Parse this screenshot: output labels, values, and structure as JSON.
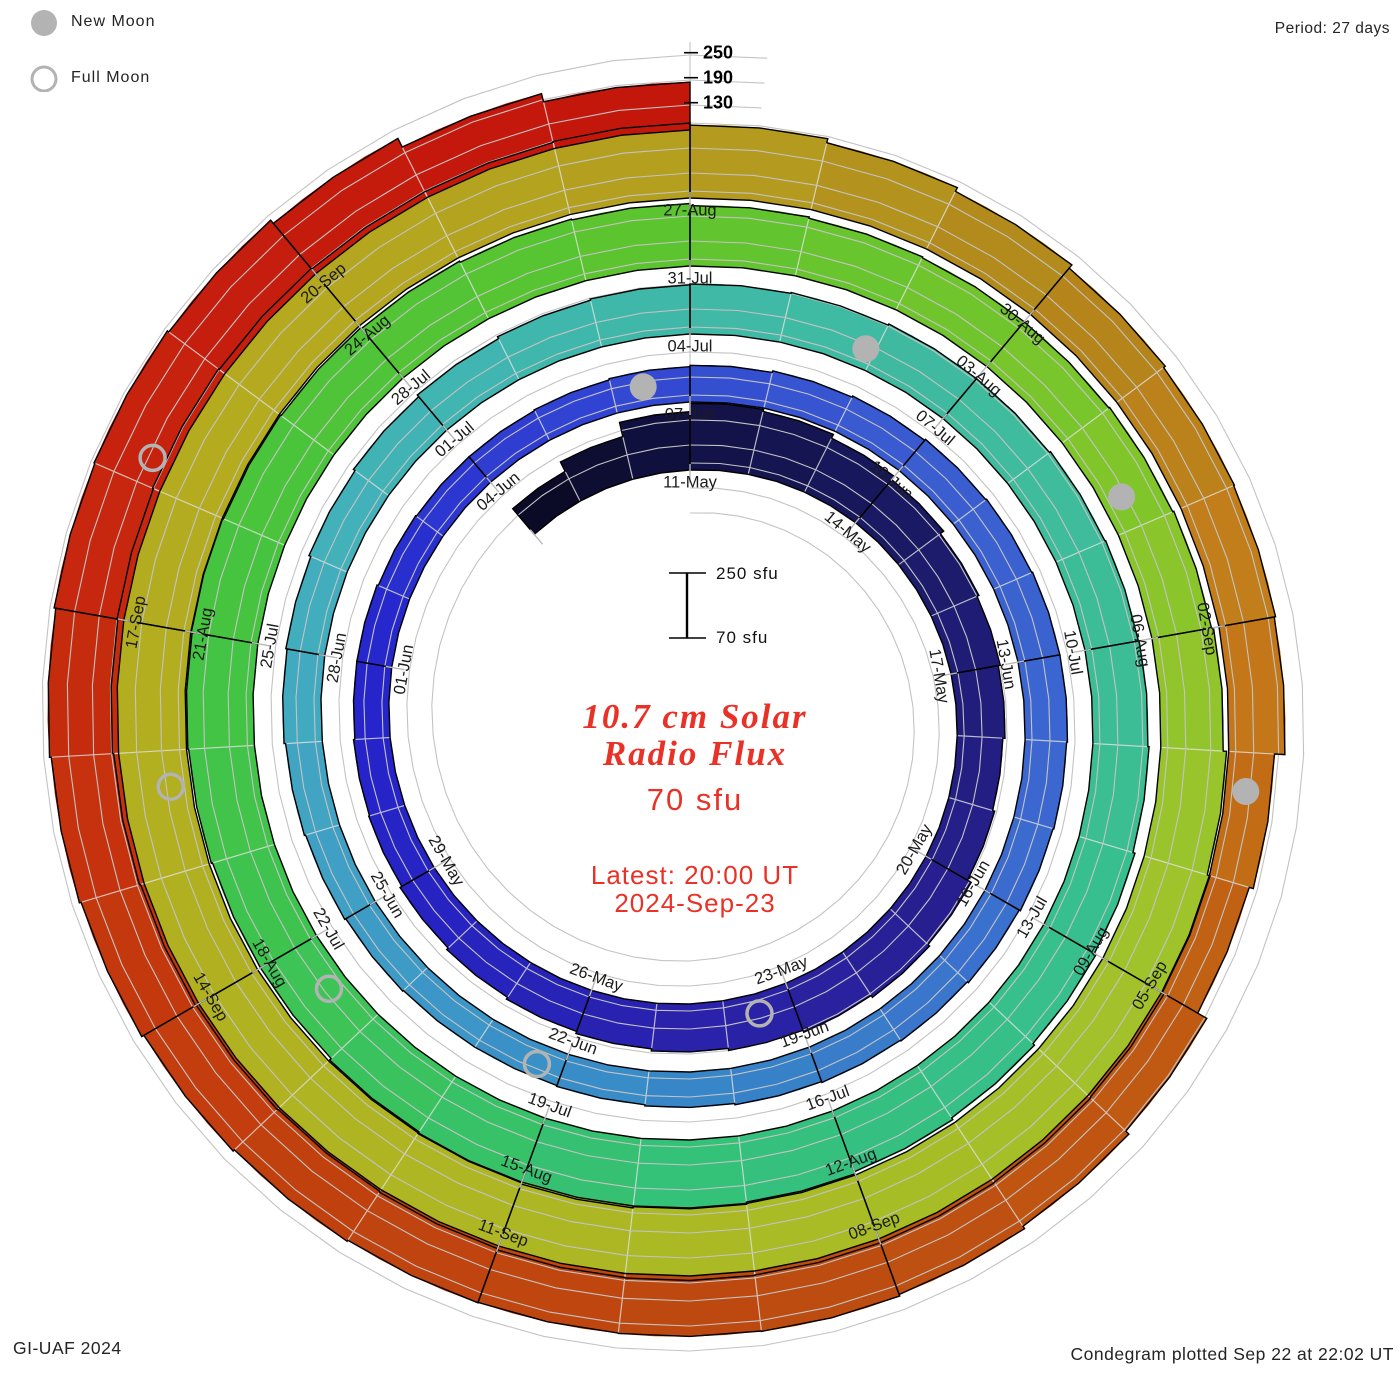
{
  "header": {
    "period_label": "Period: 27 days"
  },
  "legend": {
    "new_moon": "New Moon",
    "full_moon": "Full Moon"
  },
  "footer": {
    "left": "GI-UAF 2024",
    "right": "Condegram plotted Sep 22 at 22:02 UT"
  },
  "center": {
    "title_line1": "10.7 cm Solar",
    "title_line2": "Radio Flux",
    "flux_value": "70 sfu",
    "latest_line1": "Latest: 20:00 UT",
    "latest_line2": "2024-Sep-23"
  },
  "scale_bar": {
    "top": "250 sfu",
    "bottom": "70 sfu"
  },
  "colors": {
    "moon_gray": "#b3b3b3",
    "grid_gray": "#c3c3c3",
    "accent_red": "#e93227",
    "outline_black": "#000000"
  },
  "chart_data": {
    "type": "bar",
    "subtype": "condegram spiral (polar bar chart, one turn = 27 days, clockwise from top)",
    "title": "10.7 cm Solar Radio Flux",
    "units": "sfu",
    "period_days": 27,
    "start_day": "2024-05-08",
    "flux_base_sfu": 70,
    "radial_gridlines_sfu": [
      130,
      190,
      250
    ],
    "daily_flux_sfu": [
      150,
      175,
      210,
      230,
      225,
      215,
      205,
      195,
      190,
      185,
      180,
      185,
      195,
      200,
      195,
      190,
      185,
      180,
      175,
      170,
      165,
      160,
      158,
      155,
      155,
      152,
      150,
      150,
      152,
      155,
      158,
      162,
      165,
      168,
      170,
      172,
      172,
      170,
      168,
      165,
      162,
      160,
      158,
      155,
      152,
      150,
      150,
      152,
      155,
      158,
      162,
      165,
      170,
      175,
      180,
      185,
      188,
      190,
      192,
      195,
      195,
      198,
      200,
      202,
      205,
      210,
      215,
      220,
      225,
      230,
      235,
      238,
      235,
      230,
      225,
      225,
      228,
      230,
      232,
      230,
      228,
      225,
      222,
      220,
      215,
      212,
      210,
      210,
      212,
      215,
      220,
      228,
      235,
      240,
      242,
      243,
      243,
      244,
      243,
      240,
      238,
      240,
      242,
      245,
      248,
      250,
      252,
      250,
      248,
      248,
      250,
      245,
      235,
      225,
      215,
      210,
      208,
      205,
      180,
      170,
      195,
      205,
      212,
      216,
      215,
      214,
      215,
      218,
      222,
      228,
      232,
      236,
      240,
      242,
      238,
      228,
      205,
      185
    ],
    "date_labels": [
      {
        "d": 3,
        "label": "11-May"
      },
      {
        "d": 6,
        "label": "14-May"
      },
      {
        "d": 9,
        "label": "17-May"
      },
      {
        "d": 12,
        "label": "20-May"
      },
      {
        "d": 15,
        "label": "23-May"
      },
      {
        "d": 18,
        "label": "26-May"
      },
      {
        "d": 21,
        "label": "29-May"
      },
      {
        "d": 24,
        "label": "01-Jun"
      },
      {
        "d": 27,
        "label": "04-Jun"
      },
      {
        "d": 30,
        "label": "07-Jun"
      },
      {
        "d": 33,
        "label": "10-Jun"
      },
      {
        "d": 36,
        "label": "13-Jun"
      },
      {
        "d": 39,
        "label": "16-Jun"
      },
      {
        "d": 42,
        "label": "19-Jun"
      },
      {
        "d": 45,
        "label": "22-Jun"
      },
      {
        "d": 48,
        "label": "25-Jun"
      },
      {
        "d": 51,
        "label": "28-Jun"
      },
      {
        "d": 54,
        "label": "01-Jul"
      },
      {
        "d": 57,
        "label": "04-Jul"
      },
      {
        "d": 60,
        "label": "07-Jul"
      },
      {
        "d": 63,
        "label": "10-Jul"
      },
      {
        "d": 66,
        "label": "13-Jul"
      },
      {
        "d": 69,
        "label": "16-Jul"
      },
      {
        "d": 72,
        "label": "19-Jul"
      },
      {
        "d": 75,
        "label": "22-Jul"
      },
      {
        "d": 78,
        "label": "25-Jul"
      },
      {
        "d": 81,
        "label": "28-Jul"
      },
      {
        "d": 84,
        "label": "31-Jul"
      },
      {
        "d": 87,
        "label": "03-Aug"
      },
      {
        "d": 90,
        "label": "06-Aug"
      },
      {
        "d": 93,
        "label": "09-Aug"
      },
      {
        "d": 96,
        "label": "12-Aug"
      },
      {
        "d": 99,
        "label": "15-Aug"
      },
      {
        "d": 102,
        "label": "18-Aug"
      },
      {
        "d": 105,
        "label": "21-Aug"
      },
      {
        "d": 108,
        "label": "24-Aug"
      },
      {
        "d": 111,
        "label": "27-Aug"
      },
      {
        "d": 114,
        "label": "30-Aug"
      },
      {
        "d": 117,
        "label": "02-Sep"
      },
      {
        "d": 120,
        "label": "05-Sep"
      },
      {
        "d": 123,
        "label": "08-Sep"
      },
      {
        "d": 126,
        "label": "11-Sep"
      },
      {
        "d": 129,
        "label": "14-Sep"
      },
      {
        "d": 132,
        "label": "17-Sep"
      },
      {
        "d": 135,
        "label": "20-Sep"
      }
    ],
    "moons": {
      "new_moon_days": [
        29.4,
        58.9,
        88.7,
        118.3
      ],
      "full_moon_days": [
        15.5,
        45.3,
        74.5,
        103.7,
        133.2
      ]
    },
    "color_stops": [
      {
        "day": 0,
        "color": "#0a0a22"
      },
      {
        "day": 4,
        "color": "#14144e"
      },
      {
        "day": 8,
        "color": "#1d1c70"
      },
      {
        "day": 12,
        "color": "#261f8c"
      },
      {
        "day": 16,
        "color": "#2a22a8"
      },
      {
        "day": 20,
        "color": "#2723c0"
      },
      {
        "day": 24,
        "color": "#2525cc"
      },
      {
        "day": 28,
        "color": "#3040d2"
      },
      {
        "day": 33,
        "color": "#3a5dd0"
      },
      {
        "day": 38,
        "color": "#3c68d0"
      },
      {
        "day": 43,
        "color": "#3684c8"
      },
      {
        "day": 48,
        "color": "#3e9dc6"
      },
      {
        "day": 52,
        "color": "#42b0bc"
      },
      {
        "day": 56,
        "color": "#40b8aa"
      },
      {
        "day": 62,
        "color": "#3ebc9a"
      },
      {
        "day": 67,
        "color": "#36c08a"
      },
      {
        "day": 71,
        "color": "#34c175"
      },
      {
        "day": 75,
        "color": "#3ec352"
      },
      {
        "day": 79,
        "color": "#48c43c"
      },
      {
        "day": 84,
        "color": "#5ec42e"
      },
      {
        "day": 88,
        "color": "#7cc62a"
      },
      {
        "day": 92,
        "color": "#9ec42c"
      },
      {
        "day": 97,
        "color": "#aaba24"
      },
      {
        "day": 102,
        "color": "#b1b121"
      },
      {
        "day": 107,
        "color": "#b4aa1f"
      },
      {
        "day": 111,
        "color": "#b49e1e"
      },
      {
        "day": 114,
        "color": "#b2871c"
      },
      {
        "day": 117,
        "color": "#c47c1a"
      },
      {
        "day": 120,
        "color": "#c05b12"
      },
      {
        "day": 124,
        "color": "#bd4a10"
      },
      {
        "day": 128,
        "color": "#c2400e"
      },
      {
        "day": 131,
        "color": "#c52f0d"
      },
      {
        "day": 134,
        "color": "#c61f0e"
      },
      {
        "day": 137,
        "color": "#c4170c"
      }
    ],
    "layout": {
      "center_x": 690,
      "center_y": 720,
      "base_radius_first_turn": 250,
      "turn_spacing_px": 68,
      "px_per_60_sfu": 25,
      "grid_on": true,
      "legend_position": "top-left"
    }
  }
}
